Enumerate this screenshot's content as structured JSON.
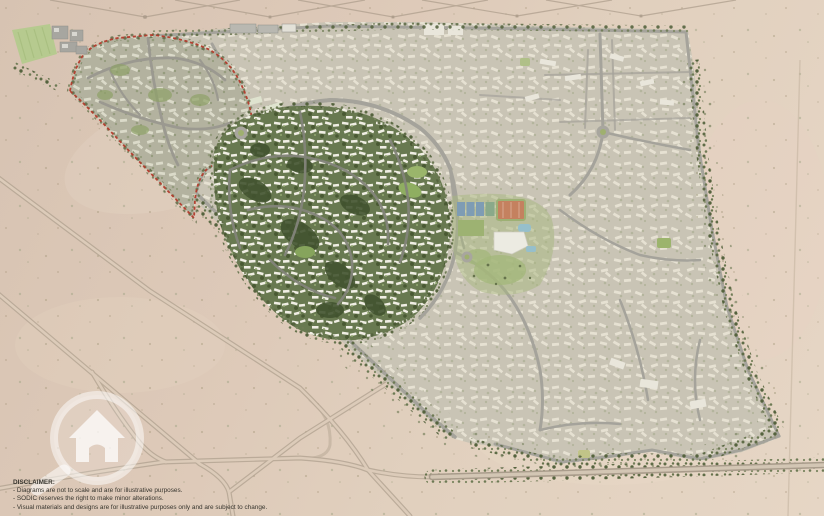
{
  "map": {
    "kind": "residential-masterplan-aerial",
    "features": [
      {
        "name": "red-dashed-boundary",
        "note": "red dashed outline around north-west parcel",
        "color": "#b23b2c"
      },
      {
        "name": "highlighted-district",
        "note": "dense green central neighborhood shown in focus"
      },
      {
        "name": "muted-districts",
        "note": "surrounding built fabric shown desaturated"
      },
      {
        "name": "sports-club",
        "note": "courts, orange pitch, pools, lawns"
      },
      {
        "name": "roundabouts",
        "count": 3
      },
      {
        "name": "desert-roads",
        "note": "parallel diagonal roads crossing open desert"
      },
      {
        "name": "tree-lined-boulevard",
        "note": "tree-lined approach road along bottom edge"
      },
      {
        "name": "transmission-lines",
        "note": "pylon wire Vs along top desert strip"
      }
    ]
  },
  "colors": {
    "desert": "#dcc8b6",
    "desert_light": "#e6d7c6",
    "urban_muted": "#b7b4a7",
    "road_gray": "#a8a69e",
    "building_white": "#eae7dd",
    "highlight_green": "#687950",
    "tree_dark": "#46552f",
    "red": "#b23b2c",
    "court_blue": "#7e9cb4",
    "pitch_orange": "#c4815f",
    "pool_blue": "#96bfcb",
    "lawn_green": "#a3b779",
    "watermark_white": "#ffffff"
  },
  "watermark": {
    "icon": "magnifier-house-icon"
  },
  "disclaimer": {
    "heading": "DISCLAIMER:",
    "lines": [
      "- Diagrams are not to scale and are for illustrative purposes.",
      "- SODIC reserves the right to make minor alterations.",
      "- Visual materials and designs are for illustrative purposes only and are subject to change."
    ]
  }
}
